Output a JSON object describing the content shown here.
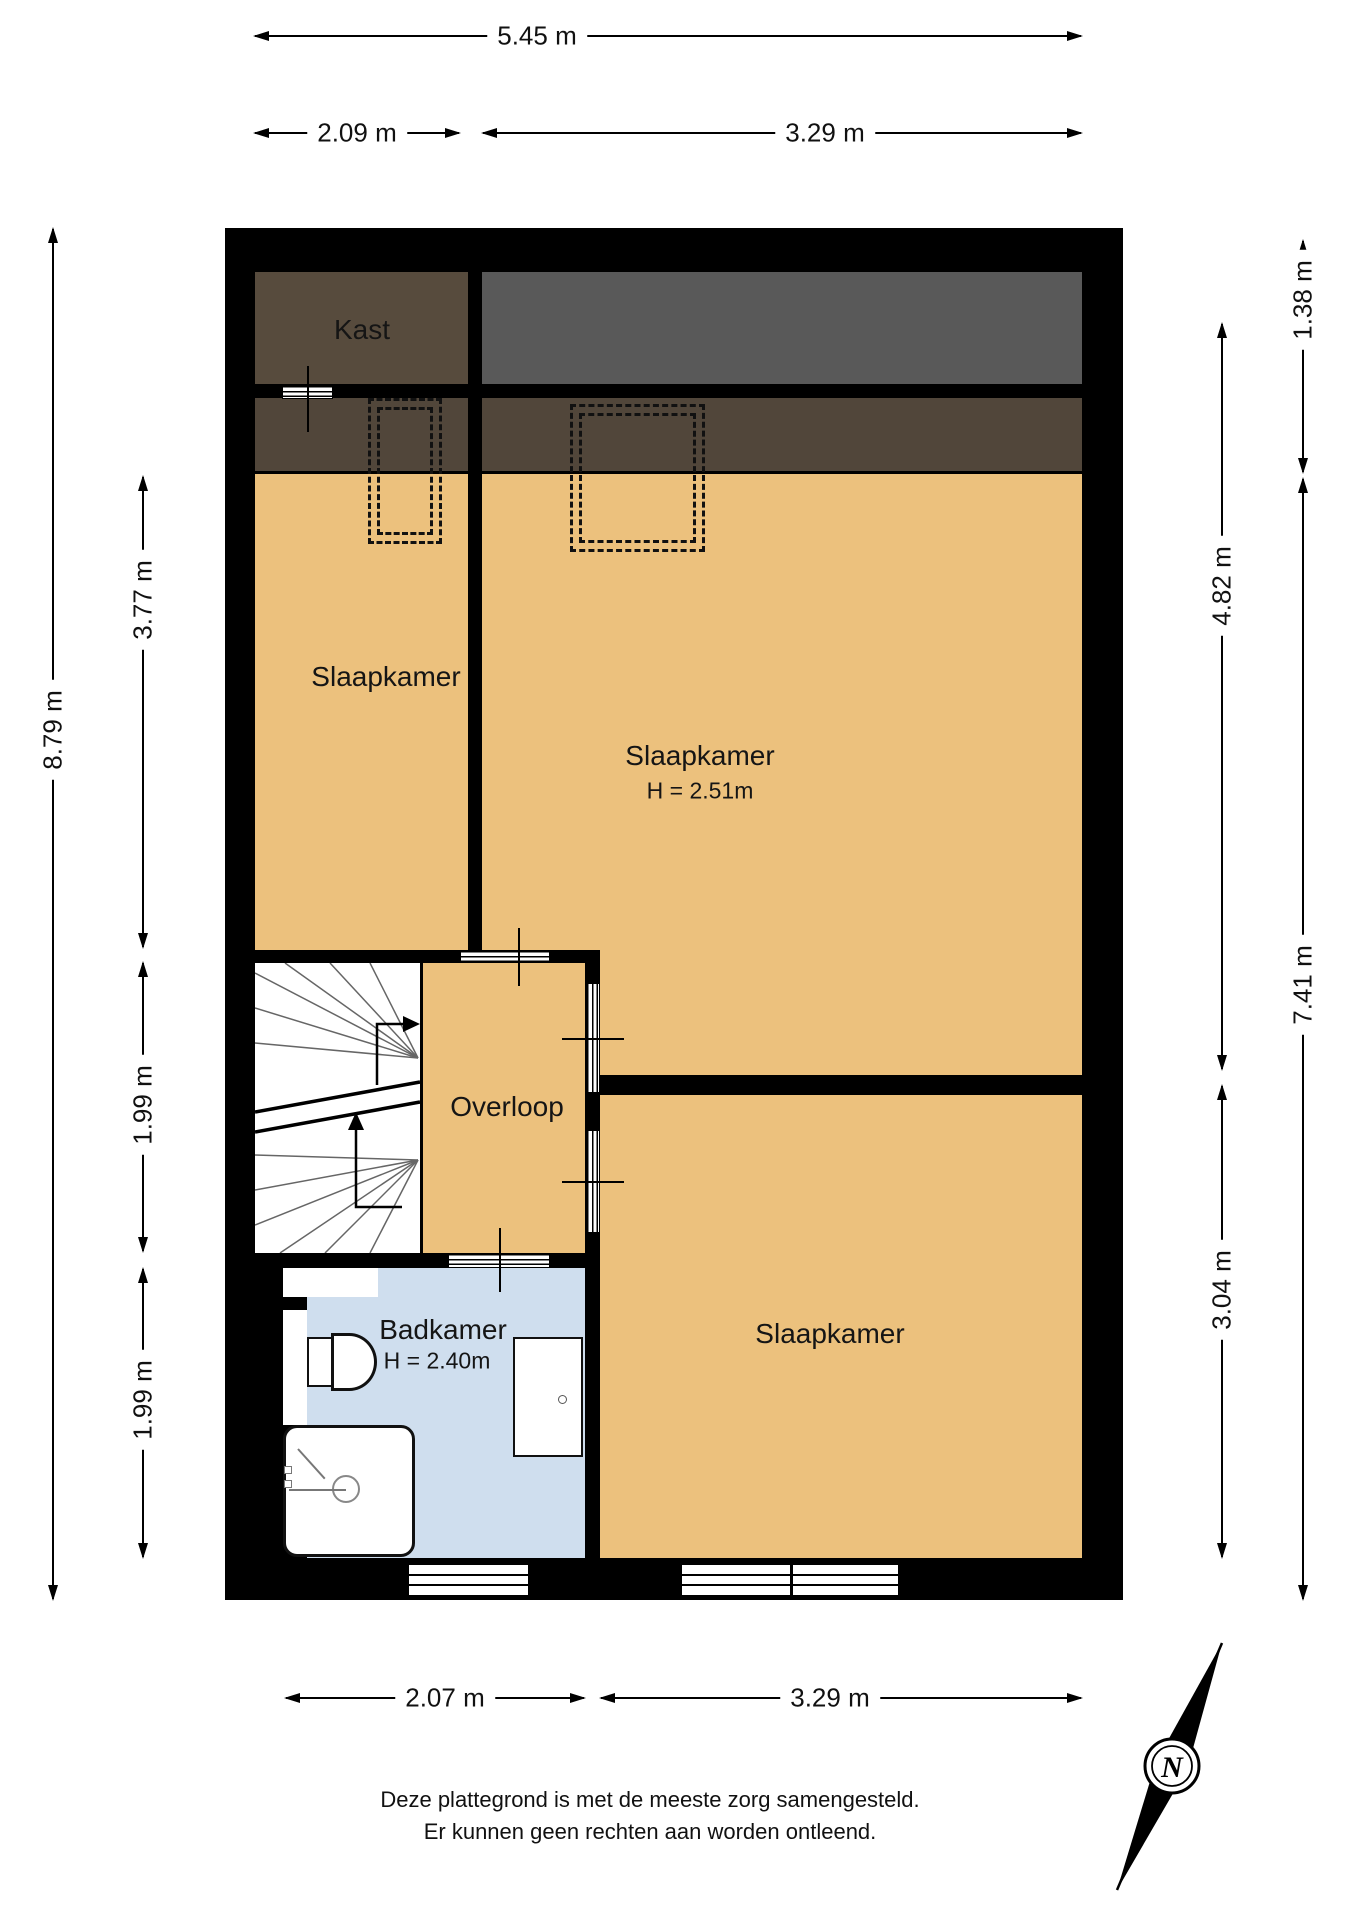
{
  "rooms": {
    "kast": "Kast",
    "bedroom_left": "Slaapkamer",
    "bedroom_right": "Slaapkamer",
    "bedroom_right_height": "H = 2.51m",
    "landing": "Overloop",
    "bathroom": "Badkamer",
    "bathroom_height": "H = 2.40m",
    "bedroom_bottom": "Slaapkamer"
  },
  "dimensions": {
    "top_total": "5.45 m",
    "top_left": "2.09 m",
    "top_right": "3.29 m",
    "bottom_left": "2.07 m",
    "bottom_right": "3.29 m",
    "left_total": "8.79 m",
    "left_upper": "3.77 m",
    "left_middle": "1.99 m",
    "left_lower": "1.99 m",
    "right_top": "1.38 m",
    "right_total": "7.41 m",
    "right_upper": "4.82 m",
    "right_lower": "3.04 m"
  },
  "footer": {
    "line1": "Deze plattegrond is met de meeste zorg samengesteld.",
    "line2": "Er kunnen geen rechten aan worden ontleend."
  },
  "compass": {
    "north": "N"
  },
  "colors": {
    "wall": "#000000",
    "floor": "#ecc17d",
    "closet": "#574b3d",
    "attic_gray": "#595959",
    "roof_band": "#51463a",
    "bathroom": "#cfdeee"
  }
}
